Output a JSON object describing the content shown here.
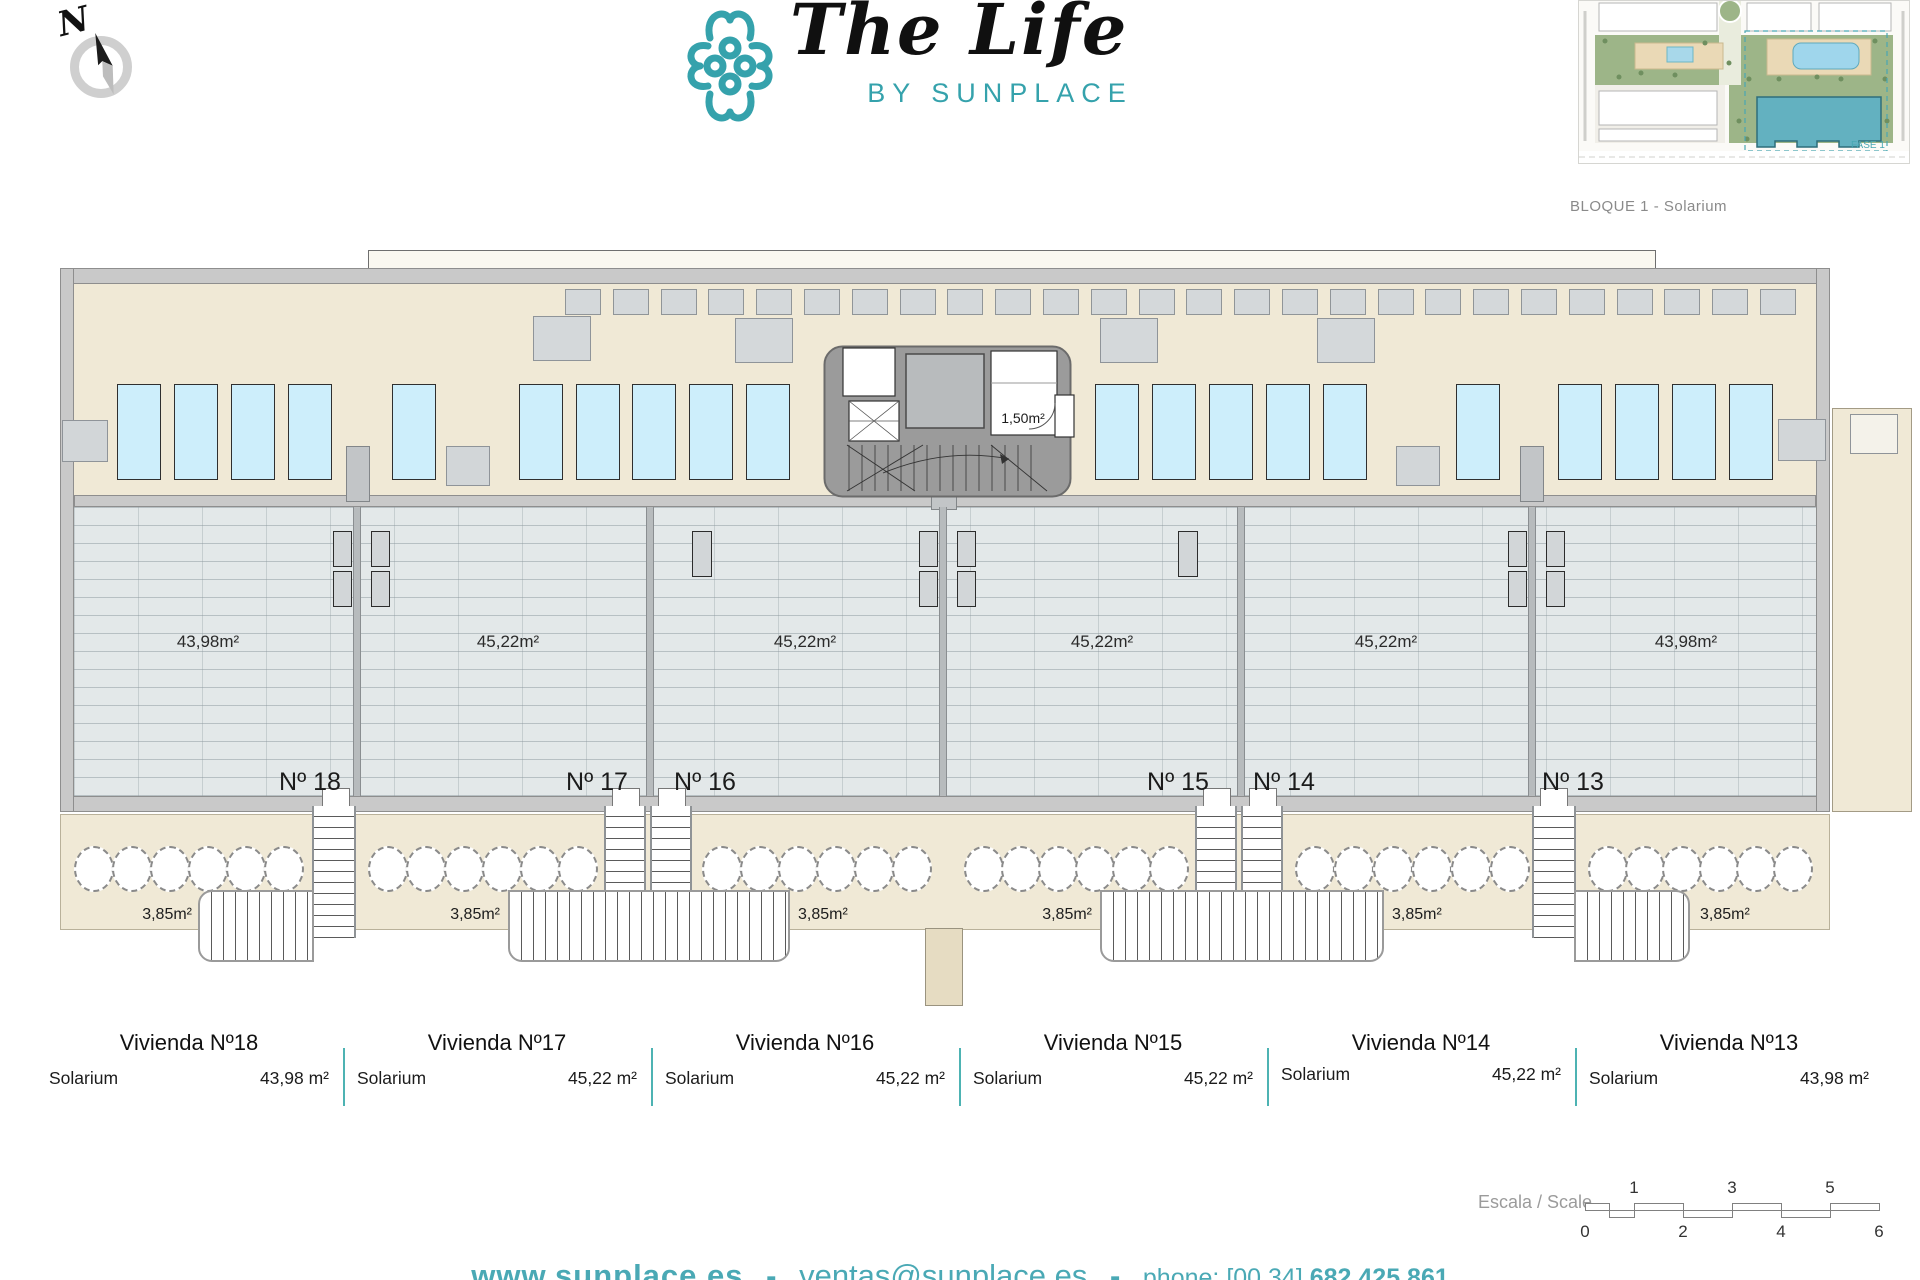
{
  "header": {
    "logo_title": "The Life",
    "logo_subtitle": "BY SUNPLACE",
    "compass_north": "N"
  },
  "site_plan": {
    "caption": "BLOQUE 1 - Solarium",
    "phase_label": "FASE 1"
  },
  "plan": {
    "core_room_area": "1,50m²",
    "stair_area": "3,85m²",
    "units": [
      {
        "number": "Nº 18",
        "area": "43,98m²"
      },
      {
        "number": "Nº 17",
        "area": "45,22m²"
      },
      {
        "number": "Nº 16",
        "area": "45,22m²"
      },
      {
        "number": "Nº 15",
        "area": "45,22m²"
      },
      {
        "number": "Nº 14",
        "area": "45,22m²"
      },
      {
        "number": "Nº 13",
        "area": "43,98m²"
      }
    ]
  },
  "legend": {
    "columns": [
      {
        "title": "Vivienda Nº18",
        "label": "Solarium",
        "value": "43,98 m²"
      },
      {
        "title": "Vivienda Nº17",
        "label": "Solarium",
        "value": "45,22 m²"
      },
      {
        "title": "Vivienda Nº16",
        "label": "Solarium",
        "value": "45,22 m²"
      },
      {
        "title": "Vivienda Nº15",
        "label": "Solarium",
        "value": "45,22 m²"
      },
      {
        "title": "Vivienda Nº14",
        "label": "Solarium",
        "value": "45,22 m²"
      },
      {
        "title": "Vivienda Nº13",
        "label": "Solarium",
        "value": "43,98 m²"
      }
    ]
  },
  "scale_bar": {
    "label": "Escala / Scale",
    "top_numbers": [
      "1",
      "3",
      "5"
    ],
    "bottom_numbers": [
      "0",
      "2",
      "4",
      "6"
    ]
  },
  "footer": {
    "website": "www.sunplace.es",
    "separator": "-",
    "email": "ventas@sunplace.es",
    "phone_label": "phone: [00 34]",
    "phone_number": "682 425 861"
  },
  "colors": {
    "teal": "#35a2ac",
    "legend_divider": "#4db3b3",
    "beige": "#f0e9d6",
    "tile": "#e3e8e9",
    "lounger_blue": "#cdeefb",
    "wall_gray": "#c9c9c9"
  }
}
